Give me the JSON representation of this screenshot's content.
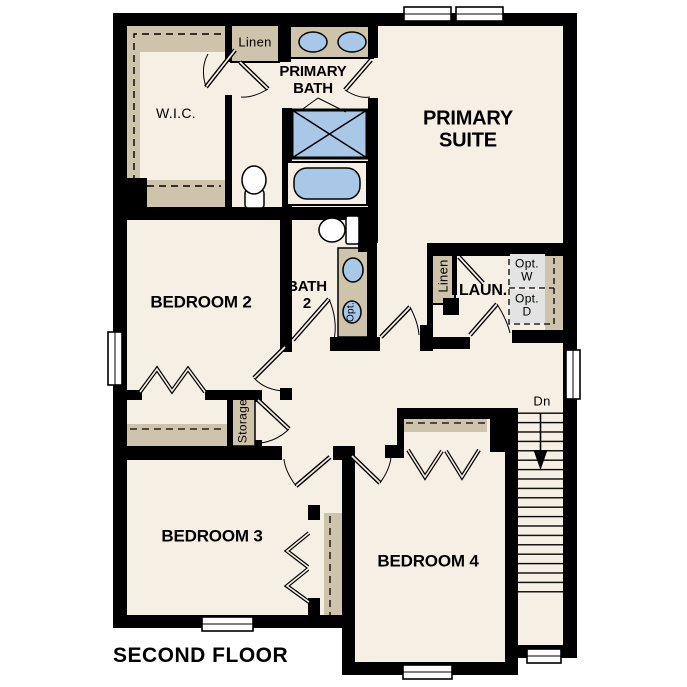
{
  "floor_plan": {
    "title": "SECOND FLOOR",
    "rooms": {
      "primary_suite": "PRIMARY\nSUITE",
      "primary_bath": "PRIMARY\nBATH",
      "wic": "W.I.C.",
      "bedroom_2": "BEDROOM 2",
      "bath_2": "BATH\n2",
      "bedroom_3": "BEDROOM 3",
      "bedroom_4": "BEDROOM 4",
      "laundry": "LAUN."
    },
    "closets": {
      "linen_upper": "Linen",
      "linen_laundry": "Linen",
      "storage": "Storage"
    },
    "annotations": {
      "stair_direction": "Dn",
      "optional_washer": "Opt.\nW",
      "optional_dryer": "Opt.\nD",
      "optional_sink": "Opt."
    },
    "colors": {
      "background": "#ffffff",
      "floor": "#f6efe3",
      "wall": "#000000",
      "casework_tan": "#cec3ab",
      "fixture_blue": "#a9c7e6",
      "appliance_gray": "#e3e3e3"
    }
  }
}
